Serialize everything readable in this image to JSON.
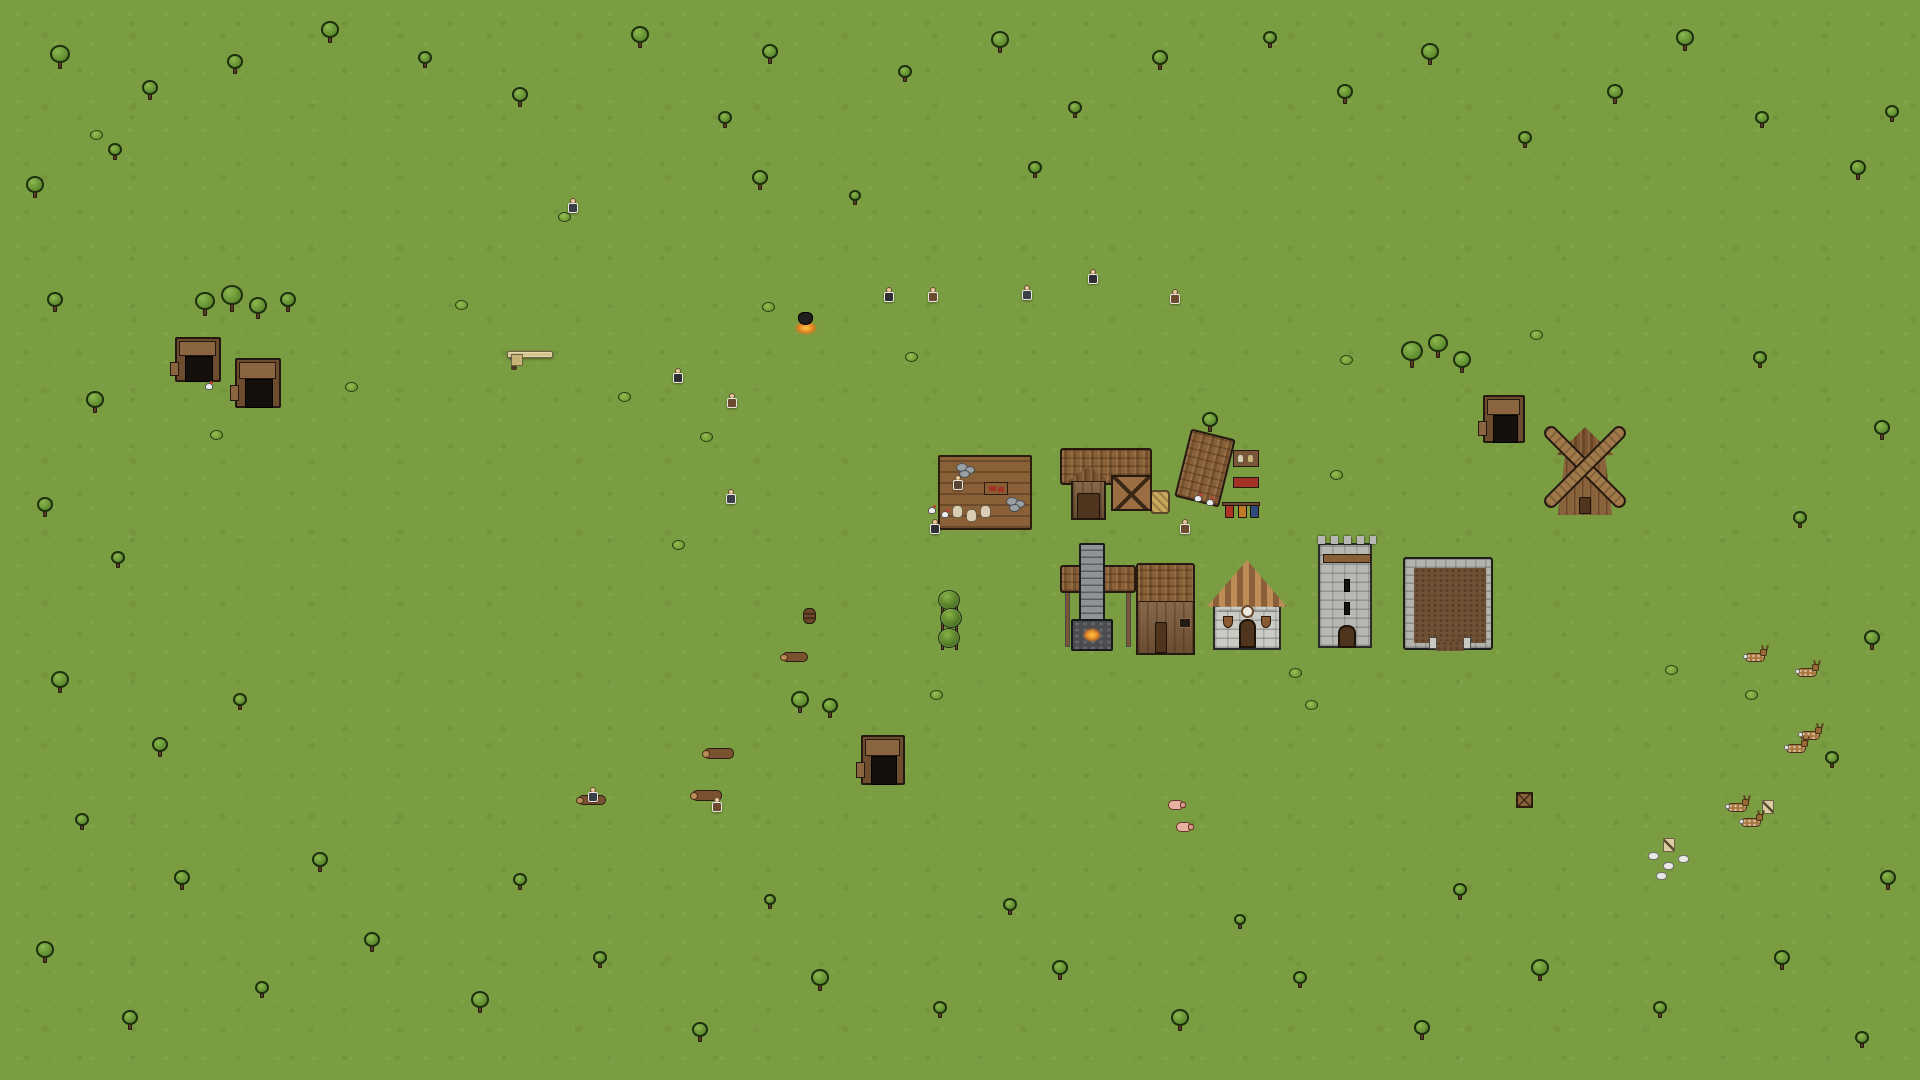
{
  "ui": {
    "building_panel": {
      "title": "Dairy",
      "rows": [
        {
          "icon": "villager-icon",
          "value": "144"
        },
        {
          "icon": "stone-icon",
          "value": "400"
        },
        {
          "icon": "stone-icon",
          "value": "84"
        }
      ],
      "close_glyph": "×"
    }
  },
  "palette": {
    "grass": "#7b9d41",
    "path": "#b9a971",
    "water": "#3d98b7",
    "thatch": "#8a6038",
    "wood": "#7b5a3a",
    "stone_grey": "#8f9296",
    "panel_bg": "#d3c491",
    "outline": "#241811"
  },
  "scene": {
    "water": [
      [
        1823,
        0,
        97,
        14
      ],
      [
        1850,
        0,
        70,
        84
      ]
    ],
    "water_light": [
      [
        1884,
        2,
        34,
        18
      ]
    ],
    "paths": [
      [
        290,
        352,
        1015,
        14
      ],
      [
        296,
        352,
        13,
        310
      ],
      [
        296,
        540,
        415,
        13
      ],
      [
        733,
        352,
        13,
        166
      ],
      [
        733,
        505,
        210,
        13
      ],
      [
        622,
        540,
        13,
        316
      ],
      [
        497,
        540,
        13,
        125
      ],
      [
        622,
        845,
        862,
        13
      ],
      [
        1212,
        655,
        286,
        13
      ],
      [
        1240,
        655,
        13,
        200
      ],
      [
        1496,
        441,
        13,
        44
      ],
      [
        1576,
        513,
        13,
        38
      ],
      [
        200,
        404,
        13,
        36
      ],
      [
        1240,
        645,
        12,
        12
      ],
      [
        1338,
        645,
        12,
        12
      ],
      [
        1441,
        645,
        12,
        12
      ]
    ],
    "patches_dark": [
      [
        150,
        120,
        170,
        90
      ],
      [
        420,
        180,
        150,
        80
      ],
      [
        90,
        540,
        140,
        90
      ],
      [
        200,
        900,
        190,
        100
      ],
      [
        500,
        760,
        150,
        80
      ],
      [
        640,
        900,
        170,
        90
      ],
      [
        840,
        960,
        190,
        90
      ],
      [
        1100,
        930,
        180,
        90
      ],
      [
        1350,
        900,
        170,
        80
      ],
      [
        1600,
        930,
        180,
        90
      ],
      [
        1760,
        840,
        150,
        80
      ],
      [
        1820,
        300,
        150,
        90
      ],
      [
        1650,
        220,
        160,
        80
      ],
      [
        1450,
        150,
        150,
        80
      ],
      [
        1150,
        120,
        160,
        80
      ],
      [
        900,
        60,
        150,
        70
      ],
      [
        620,
        70,
        140,
        70
      ],
      [
        60,
        380,
        120,
        80
      ],
      [
        980,
        920,
        160,
        80
      ],
      [
        300,
        1000,
        170,
        80
      ],
      [
        720,
        1010,
        160,
        80
      ],
      [
        1240,
        1000,
        160,
        80
      ],
      [
        1700,
        1040,
        150,
        70
      ],
      [
        40,
        60,
        120,
        70
      ],
      [
        1880,
        560,
        100,
        80
      ]
    ],
    "patches_brown": [
      [
        250,
        140,
        130,
        60
      ],
      [
        640,
        120,
        120,
        55
      ],
      [
        1190,
        90,
        130,
        60
      ],
      [
        1400,
        190,
        120,
        55
      ],
      [
        1740,
        120,
        130,
        60
      ],
      [
        340,
        960,
        130,
        60
      ],
      [
        700,
        1000,
        130,
        55
      ],
      [
        1240,
        990,
        120,
        55
      ],
      [
        1560,
        860,
        130,
        60
      ],
      [
        120,
        780,
        120,
        55
      ],
      [
        1020,
        140,
        110,
        50
      ],
      [
        1590,
        380,
        110,
        55
      ],
      [
        1860,
        980,
        110,
        50
      ],
      [
        480,
        80,
        110,
        50
      ],
      [
        60,
        900,
        110,
        50
      ]
    ],
    "plateaus": [
      [
        145,
        283,
        133,
        64,
        0
      ],
      [
        278,
        288,
        68,
        52,
        0
      ],
      [
        1300,
        318,
        190,
        78,
        0
      ],
      [
        1440,
        330,
        105,
        72,
        0
      ],
      [
        1322,
        338,
        66,
        52,
        1
      ],
      [
        731,
        693,
        114,
        36,
        0
      ],
      [
        1638,
        653,
        64,
        56,
        1
      ],
      [
        1700,
        666,
        90,
        47,
        0
      ]
    ],
    "stones": [
      [
        145,
        342,
        32,
        60
      ],
      [
        222,
        348,
        62,
        74
      ],
      [
        285,
        338,
        60,
        100
      ],
      [
        1293,
        376,
        30,
        66
      ],
      [
        1322,
        388,
        68,
        54
      ],
      [
        1388,
        416,
        94,
        28
      ],
      [
        731,
        727,
        132,
        74
      ],
      [
        843,
        697,
        63,
        103
      ],
      [
        1638,
        707,
        64,
        80
      ],
      [
        1702,
        711,
        88,
        40
      ],
      [
        1620,
        823,
        105,
        55
      ],
      [
        1725,
        786,
        118,
        38
      ]
    ],
    "fields": [
      [
        945,
        753,
        115,
        88
      ],
      [
        1237,
        753,
        98,
        88
      ]
    ],
    "pens": [
      [
        1095,
        753,
        105,
        88
      ],
      [
        1375,
        753,
        100,
        88
      ]
    ],
    "pen_barns": [
      [
        1138,
        743,
        62,
        57
      ],
      [
        1420,
        743,
        55,
        57
      ]
    ],
    "troughs": [
      [
        1100,
        758,
        28,
        11
      ],
      [
        1380,
        758,
        28,
        11
      ]
    ],
    "pigs": [
      [
        1168,
        800
      ],
      [
        1176,
        822
      ]
    ],
    "tufts": [
      [
        1110,
        790
      ],
      [
        1125,
        820
      ],
      [
        1150,
        835
      ],
      [
        1160,
        770
      ],
      [
        1398,
        790
      ],
      [
        1420,
        820
      ],
      [
        1448,
        830
      ],
      [
        1460,
        792
      ],
      [
        1442,
        760
      ]
    ],
    "long_wall": {
      "rect": [
        392,
        477,
        253,
        33
      ],
      "fill": [
        400,
        486,
        238,
        15
      ]
    },
    "hedges": [
      [
        404,
        519
      ],
      [
        428,
        519
      ],
      [
        452,
        519
      ],
      [
        476,
        519
      ],
      [
        500,
        519
      ],
      [
        524,
        519
      ],
      [
        548,
        519
      ],
      [
        572,
        519
      ],
      [
        596,
        519
      ],
      [
        620,
        519
      ],
      [
        644,
        519
      ]
    ],
    "cottages": [
      [
        398,
        276,
        98,
        75,
        {
          "dm": 1,
          "c": 0.55
        }
      ],
      [
        520,
        257,
        92,
        94,
        {
          "g": 1,
          "c": 0.52
        }
      ],
      [
        658,
        267,
        95,
        84,
        {
          "dm": 1,
          "c": 0.5
        }
      ],
      [
        796,
        267,
        98,
        84,
        {
          "g": 1,
          "c": 0.46
        }
      ],
      [
        925,
        267,
        97,
        84,
        {
          "dm": 1,
          "c": 0.5
        }
      ],
      [
        1047,
        257,
        116,
        94,
        {
          "g": 1,
          "c": 0.62
        }
      ],
      [
        1185,
        279,
        76,
        72,
        {
          "dm": 1,
          "c": 0.35
        }
      ],
      [
        740,
        370,
        115,
        80,
        {
          "g": 1,
          "c": 0.65
        }
      ],
      [
        243,
        487,
        87,
        79,
        {
          "g": 1,
          "c": 0.45
        }
      ],
      [
        228,
        585,
        112,
        87,
        {
          "g": 1,
          "c": 0.5
        }
      ],
      [
        441,
        557,
        110,
        101,
        {
          "g": 1,
          "c": 0.18,
          "c2": 0.82
        }
      ],
      [
        961,
        557,
        86,
        98,
        {
          "g": 1,
          "c": 0.55
        }
      ],
      [
        1531,
        553,
        85,
        86,
        {
          "store": 1
        }
      ],
      [
        398,
        680,
        92,
        89,
        {
          "dm": 1,
          "c": 0.5
        }
      ],
      [
        512,
        686,
        100,
        83,
        {
          "g": 1,
          "c": 0.5
        }
      ],
      [
        637,
        698,
        63,
        71,
        {
          "dm": 1,
          "c": 0.45
        }
      ],
      [
        810,
        585,
        62,
        72,
        {
          "white": 1
        }
      ],
      [
        986,
        432,
        46,
        48,
        {
          "hut": 1
        }
      ],
      [
        1218,
        468,
        46,
        42,
        {
          "hut": 1
        }
      ]
    ],
    "tudor": [
      708,
      524,
      104,
      136
    ],
    "church": [
      1213,
      560,
      68,
      90
    ],
    "tower": [
      1318,
      543,
      54,
      105
    ],
    "yard": [
      1403,
      557,
      90,
      93
    ],
    "windmill": [
      1545,
      427,
      80,
      88
    ],
    "barn": [
      1060,
      448,
      92,
      72
    ],
    "forge": [
      1060,
      557,
      135,
      98
    ],
    "deck": [
      938,
      455,
      94,
      75
    ],
    "weaver_roof": [
      1182,
      433,
      46,
      70
    ],
    "minehuts": [
      [
        175,
        337,
        46,
        45
      ],
      [
        235,
        358,
        46,
        50
      ],
      [
        861,
        735,
        44,
        50
      ],
      [
        1483,
        395,
        42,
        48
      ]
    ],
    "logs": [
      [
        704,
        748,
        30,
        11
      ],
      [
        692,
        790,
        30,
        11
      ],
      [
        578,
        795,
        28,
        10
      ],
      [
        782,
        652,
        26,
        10
      ]
    ],
    "sacks": [
      [
        952,
        505
      ],
      [
        966,
        509
      ],
      [
        980,
        505
      ]
    ],
    "stonepiles": [
      [
        1006,
        497
      ],
      [
        956,
        463
      ]
    ],
    "tables": [
      [
        984,
        482
      ]
    ],
    "shelves": [
      [
        1233,
        450
      ]
    ],
    "benches": [
      [
        1233,
        477
      ]
    ],
    "racks": [
      [
        1222,
        502
      ]
    ],
    "mine_signs": [
      [
        1663,
        838
      ],
      [
        1762,
        800
      ]
    ],
    "barrels": [
      [
        803,
        608
      ]
    ],
    "crates": [
      [
        1516,
        792
      ]
    ],
    "hay": [
      [
        1150,
        490
      ]
    ],
    "cauldrons": [
      [
        798,
        312
      ]
    ],
    "hops": [
      [
        937,
        590
      ]
    ],
    "white_chunks": [
      [
        1648,
        852
      ],
      [
        1663,
        862
      ],
      [
        1678,
        855
      ],
      [
        1656,
        872
      ]
    ],
    "trees": [
      [
        60,
        55,
        20
      ],
      [
        150,
        88,
        16
      ],
      [
        35,
        185,
        18
      ],
      [
        115,
        150,
        14
      ],
      [
        235,
        62,
        16
      ],
      [
        330,
        30,
        18
      ],
      [
        425,
        58,
        14
      ],
      [
        520,
        95,
        16
      ],
      [
        640,
        35,
        18
      ],
      [
        725,
        118,
        14
      ],
      [
        770,
        52,
        16
      ],
      [
        905,
        72,
        14
      ],
      [
        1000,
        40,
        18
      ],
      [
        1075,
        108,
        14
      ],
      [
        1160,
        58,
        16
      ],
      [
        1270,
        38,
        14
      ],
      [
        1345,
        92,
        16
      ],
      [
        1430,
        52,
        18
      ],
      [
        1525,
        138,
        14
      ],
      [
        1615,
        92,
        16
      ],
      [
        1685,
        38,
        18
      ],
      [
        1762,
        118,
        14
      ],
      [
        1858,
        168,
        16
      ],
      [
        1892,
        112,
        14
      ],
      [
        55,
        300,
        16
      ],
      [
        95,
        400,
        18
      ],
      [
        45,
        505,
        16
      ],
      [
        118,
        558,
        14
      ],
      [
        60,
        680,
        18
      ],
      [
        160,
        745,
        16
      ],
      [
        82,
        820,
        14
      ],
      [
        182,
        878,
        16
      ],
      [
        45,
        950,
        18
      ],
      [
        130,
        1018,
        16
      ],
      [
        262,
        988,
        14
      ],
      [
        372,
        940,
        16
      ],
      [
        480,
        1000,
        18
      ],
      [
        600,
        958,
        14
      ],
      [
        700,
        1030,
        16
      ],
      [
        820,
        978,
        18
      ],
      [
        940,
        1008,
        14
      ],
      [
        1060,
        968,
        16
      ],
      [
        1180,
        1018,
        18
      ],
      [
        1300,
        978,
        14
      ],
      [
        1422,
        1028,
        16
      ],
      [
        1540,
        968,
        18
      ],
      [
        1660,
        1008,
        14
      ],
      [
        1782,
        958,
        16
      ],
      [
        1862,
        1038,
        14
      ],
      [
        1888,
        878,
        16
      ],
      [
        1832,
        758,
        14
      ],
      [
        1872,
        638,
        16
      ],
      [
        1800,
        518,
        14
      ],
      [
        1882,
        428,
        16
      ],
      [
        1760,
        358,
        14
      ],
      [
        760,
        178,
        16
      ],
      [
        1035,
        168,
        14
      ],
      [
        855,
        196,
        12
      ],
      [
        1210,
        420,
        16
      ],
      [
        320,
        860,
        16
      ],
      [
        520,
        880,
        14
      ],
      [
        770,
        900,
        12
      ],
      [
        1010,
        905,
        14
      ],
      [
        1240,
        920,
        12
      ],
      [
        1460,
        890,
        14
      ],
      [
        240,
        700,
        14
      ],
      [
        205,
        302,
        20
      ],
      [
        232,
        296,
        22
      ],
      [
        258,
        306,
        18
      ],
      [
        288,
        300,
        16
      ],
      [
        1412,
        352,
        22
      ],
      [
        1438,
        344,
        20
      ],
      [
        1462,
        360,
        18
      ],
      [
        800,
        700,
        18
      ],
      [
        830,
        706,
        16
      ]
    ],
    "bushes": [
      [
        345,
        382
      ],
      [
        700,
        432
      ],
      [
        455,
        300
      ],
      [
        618,
        392
      ],
      [
        905,
        352
      ],
      [
        1240,
        640
      ],
      [
        1289,
        668
      ],
      [
        1305,
        700
      ],
      [
        672,
        540
      ],
      [
        930,
        690
      ],
      [
        1330,
        470
      ],
      [
        1530,
        330
      ],
      [
        210,
        430
      ],
      [
        90,
        130
      ],
      [
        1745,
        690
      ],
      [
        558,
        212
      ],
      [
        762,
        302
      ],
      [
        1340,
        355
      ],
      [
        1665,
        665
      ]
    ],
    "rocks": [
      [
        937,
        8,
        16
      ],
      [
        1283,
        20,
        14
      ],
      [
        1540,
        95,
        12
      ],
      [
        60,
        240,
        12
      ],
      [
        1760,
        25,
        12
      ],
      [
        128,
        643,
        12
      ],
      [
        1740,
        985,
        14
      ],
      [
        300,
        1050,
        12
      ],
      [
        1880,
        690,
        10
      ],
      [
        145,
        472,
        10
      ],
      [
        1815,
        905,
        12
      ],
      [
        120,
        575,
        10
      ]
    ],
    "deer": [
      [
        1745,
        649
      ],
      [
        1797,
        664
      ],
      [
        1800,
        727
      ],
      [
        1727,
        799
      ],
      [
        1741,
        814
      ],
      [
        1786,
        740
      ]
    ],
    "chickens": [
      [
        205,
        382
      ],
      [
        1194,
        494
      ],
      [
        1206,
        498
      ],
      [
        928,
        506
      ],
      [
        941,
        510
      ]
    ],
    "villagers": [
      [
        568,
        198,
        "#3b4048"
      ],
      [
        673,
        368,
        "#2f2f33"
      ],
      [
        727,
        393,
        "#6b4a2e"
      ],
      [
        726,
        489,
        "#3b4048"
      ],
      [
        884,
        287,
        "#2f2f33"
      ],
      [
        928,
        287,
        "#6b4a2e"
      ],
      [
        1022,
        285,
        "#3b4048"
      ],
      [
        1088,
        269,
        "#2f2f33"
      ],
      [
        1170,
        289,
        "#6b4a2e"
      ],
      [
        953,
        475,
        "#5a4632"
      ],
      [
        930,
        519,
        "#2f2f33"
      ],
      [
        1180,
        519,
        "#6b4a2e"
      ],
      [
        588,
        787,
        "#3b4048"
      ],
      [
        712,
        797,
        "#6b4a2e"
      ]
    ]
  }
}
